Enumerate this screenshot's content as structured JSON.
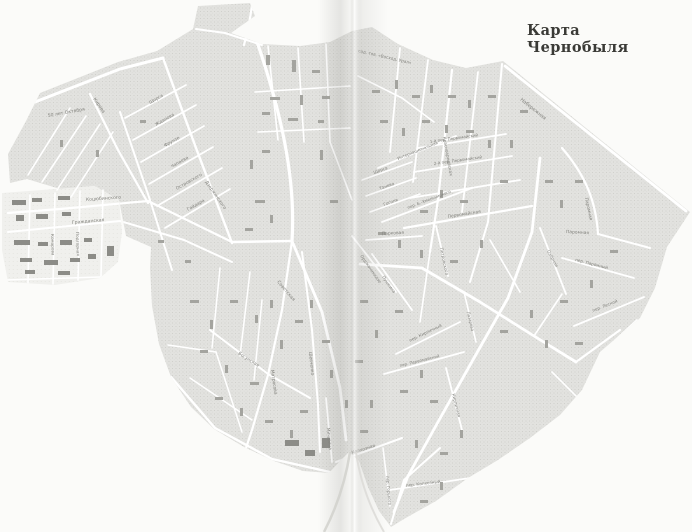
{
  "page": {
    "title": "Карта Чернобыля"
  },
  "colors": {
    "paper": "#fbfbf9",
    "title_ink": "#3a3a36",
    "label_ink": "#82827d",
    "block_fill": "#e2e2df",
    "street": "#ffffff",
    "building": "#a4a49f",
    "fold_shadow": "#8a8a85"
  },
  "map": {
    "street_labels": [
      {
        "text": "50 лет Октября",
        "x": 48,
        "y": 117,
        "r": -10,
        "s": 4.6
      },
      {
        "text": "Кирова",
        "x": 93,
        "y": 99,
        "r": 55,
        "s": 4.6
      },
      {
        "text": "Дзержинского",
        "x": 205,
        "y": 182,
        "r": 55,
        "s": 4.4
      },
      {
        "text": "Щорса",
        "x": 150,
        "y": 104,
        "r": -30,
        "s": 4.4
      },
      {
        "text": "Жданова",
        "x": 156,
        "y": 126,
        "r": -30,
        "s": 4.4
      },
      {
        "text": "Фрунзе",
        "x": 165,
        "y": 147,
        "r": -30,
        "s": 4.4
      },
      {
        "text": "Чапаева",
        "x": 172,
        "y": 168,
        "r": -30,
        "s": 4.4
      },
      {
        "text": "Островского",
        "x": 177,
        "y": 190,
        "r": -30,
        "s": 4.4
      },
      {
        "text": "Гайдара",
        "x": 188,
        "y": 211,
        "r": -30,
        "s": 4.4
      },
      {
        "text": "Коцюбинского",
        "x": 86,
        "y": 201,
        "r": -4,
        "s": 4.6
      },
      {
        "text": "Гражданская",
        "x": 72,
        "y": 224,
        "r": -5,
        "s": 4.6
      },
      {
        "text": "Комарова",
        "x": 51,
        "y": 234,
        "r": 88,
        "s": 4.2
      },
      {
        "text": "Подгорная",
        "x": 76,
        "y": 232,
        "r": 88,
        "s": 4.2
      },
      {
        "text": "Советская",
        "x": 277,
        "y": 282,
        "r": 50,
        "s": 4.6
      },
      {
        "text": "Шевченко",
        "x": 309,
        "y": 352,
        "r": 84,
        "s": 4.4
      },
      {
        "text": "Матросова",
        "x": 271,
        "y": 370,
        "r": 82,
        "s": 4.4
      },
      {
        "text": "Мичурина",
        "x": 327,
        "y": 428,
        "r": 85,
        "s": 4.2
      },
      {
        "text": "Богунская",
        "x": 238,
        "y": 354,
        "r": 33,
        "s": 4.4
      },
      {
        "text": "сад. тов. «Восход. Урал»",
        "x": 358,
        "y": 52,
        "r": 13,
        "s": 4.2
      },
      {
        "text": "Набережная",
        "x": 520,
        "y": 100,
        "r": 39,
        "s": 4.8
      },
      {
        "text": "Красноармейская",
        "x": 443,
        "y": 137,
        "r": 80,
        "s": 4.2
      },
      {
        "text": "Щорса",
        "x": 374,
        "y": 174,
        "r": -20,
        "s": 4.2
      },
      {
        "text": "Танева",
        "x": 380,
        "y": 190,
        "r": -20,
        "s": 4.2
      },
      {
        "text": "Гоголя",
        "x": 384,
        "y": 206,
        "r": -20,
        "s": 4.2
      },
      {
        "text": "Интернациональная",
        "x": 398,
        "y": 160,
        "r": -22,
        "s": 4.0
      },
      {
        "text": "пер. Б.-Хмельницкого",
        "x": 408,
        "y": 209,
        "r": -21,
        "s": 4.0
      },
      {
        "text": "1-й пер. Первомайский",
        "x": 430,
        "y": 143,
        "r": -8,
        "s": 4.0
      },
      {
        "text": "2-й пер. Первомайский",
        "x": 434,
        "y": 165,
        "r": -8,
        "s": 4.0
      },
      {
        "text": "Первомайская",
        "x": 448,
        "y": 218,
        "r": -9,
        "s": 4.4
      },
      {
        "text": "Парковая",
        "x": 382,
        "y": 235,
        "r": -3,
        "s": 4.4
      },
      {
        "text": "Петровского",
        "x": 440,
        "y": 248,
        "r": 78,
        "s": 4.2
      },
      {
        "text": "Орджоникидзе",
        "x": 360,
        "y": 256,
        "r": 55,
        "s": 4.2
      },
      {
        "text": "Пушкина",
        "x": 382,
        "y": 277,
        "r": 55,
        "s": 4.2
      },
      {
        "text": "Паромная",
        "x": 585,
        "y": 198,
        "r": 78,
        "s": 4.4
      },
      {
        "text": "Паромная",
        "x": 566,
        "y": 233,
        "r": 3,
        "s": 4.4
      },
      {
        "text": "пер. Паромный",
        "x": 575,
        "y": 261,
        "r": 14,
        "s": 4.2
      },
      {
        "text": "Озёрная",
        "x": 547,
        "y": 251,
        "r": 62,
        "s": 4.2
      },
      {
        "text": "пер. Лесной",
        "x": 593,
        "y": 312,
        "r": -22,
        "s": 4.2
      },
      {
        "text": "пер. Кирпичный",
        "x": 410,
        "y": 342,
        "r": -26,
        "s": 4.2
      },
      {
        "text": "Кирпичная",
        "x": 452,
        "y": 394,
        "r": 76,
        "s": 4.2
      },
      {
        "text": "Лазарева",
        "x": 467,
        "y": 312,
        "r": 77,
        "s": 4.0
      },
      {
        "text": "пер. Первомайский",
        "x": 400,
        "y": 367,
        "r": -14,
        "s": 4.0
      },
      {
        "text": "Колхозная",
        "x": 352,
        "y": 454,
        "r": -17,
        "s": 4.4
      },
      {
        "text": "пер. Горького",
        "x": 386,
        "y": 476,
        "r": 85,
        "s": 4.0
      },
      {
        "text": "пер. Колхозный",
        "x": 406,
        "y": 487,
        "r": -7,
        "s": 4.2
      }
    ]
  }
}
